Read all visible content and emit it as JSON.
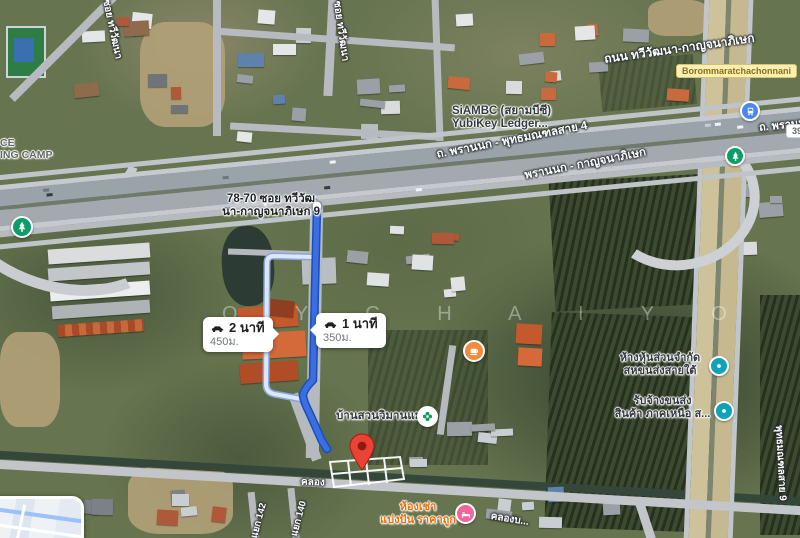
{
  "route": {
    "origin_address_line1": "78-70 ซอย ทวีวัฒ",
    "origin_address_line2": "นา-กาญจนาภิเษก 9",
    "primary": {
      "duration": "1 นาที",
      "distance": "350ม."
    },
    "alternate": {
      "duration": "2 นาที",
      "distance": "450ม."
    }
  },
  "roads": {
    "thawi_kanchana": "ถนน ทวีวัฒนา-กาญจนาภิเษก",
    "borommaratchachonnani_shield": "Borommaratchachonnani",
    "phran_nok_sai4": "ถ. พรานนก - พุทธมณฑลสาย 4",
    "phran_nok_kanchana": "พรานนก - กาญจนาภิเษก",
    "phran_nok_right": "ถ. พรานนก",
    "soi_thawi_top": "ซอย ทวีวัฒนา",
    "soi_thawi_left": "ซอย ทวีวัฒนา",
    "khlong_bottom": "คลอง",
    "khlong_right": "คลองบ...",
    "yaek_142": "แยก 142",
    "yaek_140": "แยก 140",
    "sai9_right": "พุทธมณฑลสาย 9",
    "route_shield_number": "390"
  },
  "places": {
    "siambc_line1": "SiAMBC (สยามบีซี)",
    "siambc_line2": "YubiKey Ledger...",
    "training_camp_line1": "CE",
    "training_camp_line2": "ING CAMP",
    "hang_hun_line1": "ห้างหุ้นส่วนจำกัด",
    "hang_hun_line2": "สหขนส่งสายใต้",
    "rap_jang_line1": "รับจ้างขนส่ง",
    "rap_jang_line2": "สินค้า ภาคเหนือ ส...",
    "baan_suan": "บ้านสวนวิมานแมน",
    "hong_chao_line1": "ห้องเช่า",
    "hong_chao_line2": "แบ่งปัน ราคาถูก"
  },
  "watermark": "O Y C H A I Y O",
  "colors": {
    "route_primary": "#3b6de3",
    "route_primary_casing": "#1b4fb8",
    "route_alternate": "#dbe7fb",
    "route_alternate_casing": "#8aa6d6",
    "pin_red": "#ea4335",
    "shield_yellow": "#faf0b5",
    "lodging_pink": "#f0659b",
    "cafe_orange": "#f28b3b",
    "park_green": "#0f9d58",
    "transit_blue": "#4a86f7",
    "poi_teal": "#0ea3b8"
  }
}
